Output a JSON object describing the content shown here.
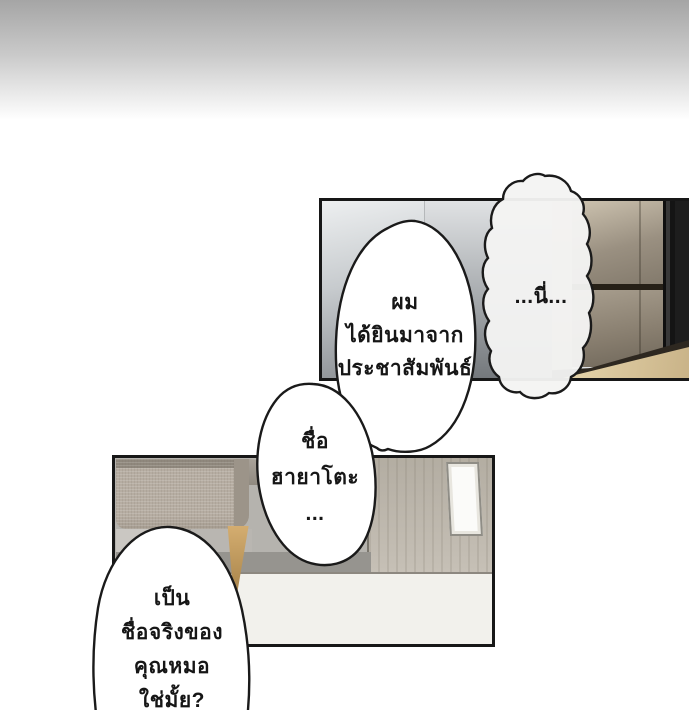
{
  "meta": {
    "kind": "webtoon-comic-page",
    "language": "th"
  },
  "bubbles": [
    {
      "name": "bubble-nii",
      "style": "cloud",
      "lines": [
        "...นี่..."
      ]
    },
    {
      "name": "bubble-heard",
      "style": "oval",
      "lines": [
        "ผม",
        "ได้ยินมาจาก",
        "ประชาสัมพันธ์"
      ]
    },
    {
      "name": "bubble-name",
      "style": "oval",
      "lines": [
        "ชื่อ",
        "ฮายาโตะ",
        "..."
      ]
    },
    {
      "name": "bubble-question",
      "style": "oval",
      "lines": [
        "เป็น",
        "ชื่อจริงของ",
        "คุณหมอ",
        "ใช่มั้ย?"
      ]
    }
  ],
  "panels": [
    {
      "name": "panel-closet",
      "description": "interior wall with wooden sliding closet, dark side column and wood floor"
    },
    {
      "name": "panel-room",
      "description": "room with fabric sofa on wooden leg, grey wall, door with narrow window, light floor"
    }
  ],
  "palette": {
    "page_background": "#ffffff",
    "top_gradient_from": "#a5a5a5",
    "top_gradient_to": "#ffffff",
    "panel_border": "#171717",
    "bubble_fill": "#ffffff",
    "bubble_stroke": "#1a1a1a",
    "text_color": "#161616",
    "closet_wood": "#9a9081",
    "closet_dark_side": "#191919",
    "floor_wood": "#e0cda3",
    "wall_grey": "#c7cbce",
    "room_wall": "#b5b3ae",
    "room_floor": "#f2f1ec",
    "door": "#c0bab0",
    "sofa_fabric": "#b6ada2",
    "sofa_leg": "#c8a268"
  }
}
